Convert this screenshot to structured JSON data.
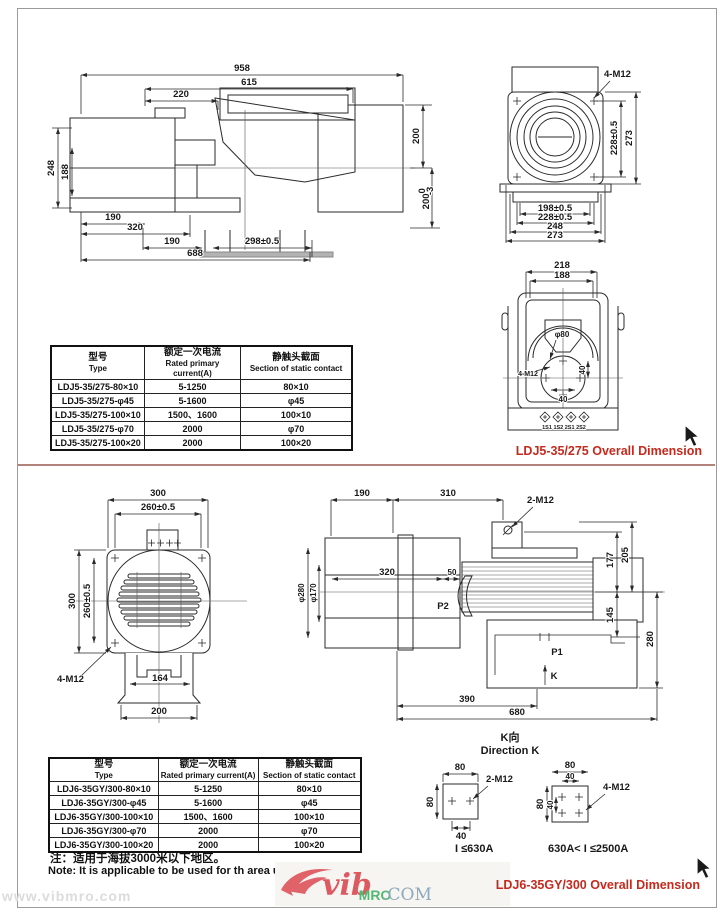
{
  "titles": {
    "section1": "LDJ5-35/275 Overall Dimension",
    "section2": "LDJ6-35GY/300 Overall Dimension"
  },
  "watermark": "www.vibmro.com",
  "logo": {
    "script": "vib",
    "mro": "MRO",
    "com": ".COM"
  },
  "sideview1": {
    "top958": "958",
    "top615": "615",
    "top220": "220",
    "left248": "248",
    "left188": "188",
    "right200": "200",
    "tol_base": "200",
    "tol_up": "0",
    "tol_dn": "-3",
    "bot190a": "190",
    "bot320": "320",
    "bot190b": "190",
    "bot298": "298±0.5",
    "bot688": "688"
  },
  "flangeview1": {
    "bolt": "4-M12",
    "v228": "228±0.5",
    "v273": "273",
    "b198": "198±0.5",
    "b228": "228±0.5",
    "b248": "248",
    "b273": "273"
  },
  "secview1": {
    "t218": "218",
    "t188": "188",
    "phi80": "φ80",
    "r40": "40",
    "b40": "40",
    "bolt": "4-M12",
    "terminals": "1S1 1S2  2S1 2S2"
  },
  "table1": {
    "headers": [
      {
        "zh": "型号",
        "en": "Type"
      },
      {
        "zh": "额定一次电流",
        "en": "Rated primary current(A)"
      },
      {
        "zh": "静触头截面",
        "en": "Section of static contact"
      }
    ],
    "rows": [
      [
        "LDJ5-35/275-80×10",
        "5-1250",
        "80×10"
      ],
      [
        "LDJ5-35/275-φ45",
        "5-1600",
        "φ45"
      ],
      [
        "LDJ5-35/275-100×10",
        "1500、1600",
        "100×10"
      ],
      [
        "LDJ5-35/275-φ70",
        "2000",
        "φ70"
      ],
      [
        "LDJ5-35/275-100×20",
        "2000",
        "100×20"
      ]
    ]
  },
  "frontview2": {
    "t300": "300",
    "t260": "260±0.5",
    "l300": "300",
    "l260": "260±0.5",
    "bolt": "4-M12",
    "b164": "164",
    "b200": "200"
  },
  "sideview2": {
    "t190": "190",
    "t310": "310",
    "bolt2": "2-M12",
    "d320": "320",
    "d50": "50",
    "phi280": "φ280",
    "phi170": "φ170",
    "p2": "P2",
    "p1": "P1",
    "k": "K",
    "r177": "177",
    "r205": "205",
    "r145": "145",
    "r280": "280",
    "b390": "390",
    "b680": "680"
  },
  "directionK": {
    "title_zh": "K向",
    "title_en": "Direction K",
    "left": {
      "t80": "80",
      "l80": "80",
      "b40": "40",
      "bolt": "2-M12",
      "caption": "I ≤630A"
    },
    "right": {
      "t80": "80",
      "t40": "40",
      "l80": "80",
      "l40": "40",
      "bolt": "4-M12",
      "caption": "630A< I ≤2500A"
    }
  },
  "table2": {
    "headers": [
      {
        "zh": "型号",
        "en": "Type"
      },
      {
        "zh": "额定一次电流",
        "en": "Rated primary current(A)"
      },
      {
        "zh": "静触头截面",
        "en": "Section of static contact"
      }
    ],
    "rows": [
      [
        "LDJ6-35GY/300-80×10",
        "5-1250",
        "80×10"
      ],
      [
        "LDJ6-35GY/300-φ45",
        "5-1600",
        "φ45"
      ],
      [
        "LDJ6-35GY/300-100×10",
        "1500、1600",
        "100×10"
      ],
      [
        "LDJ6-35GY/300-φ70",
        "2000",
        "φ70"
      ],
      [
        "LDJ6-35GY/300-100×20",
        "2000",
        "100×20"
      ]
    ]
  },
  "note": {
    "zh": "注：适用于海拔3000米以下地区。",
    "en": "Note: It is applicable to be used for th area under altitude 3000m."
  }
}
